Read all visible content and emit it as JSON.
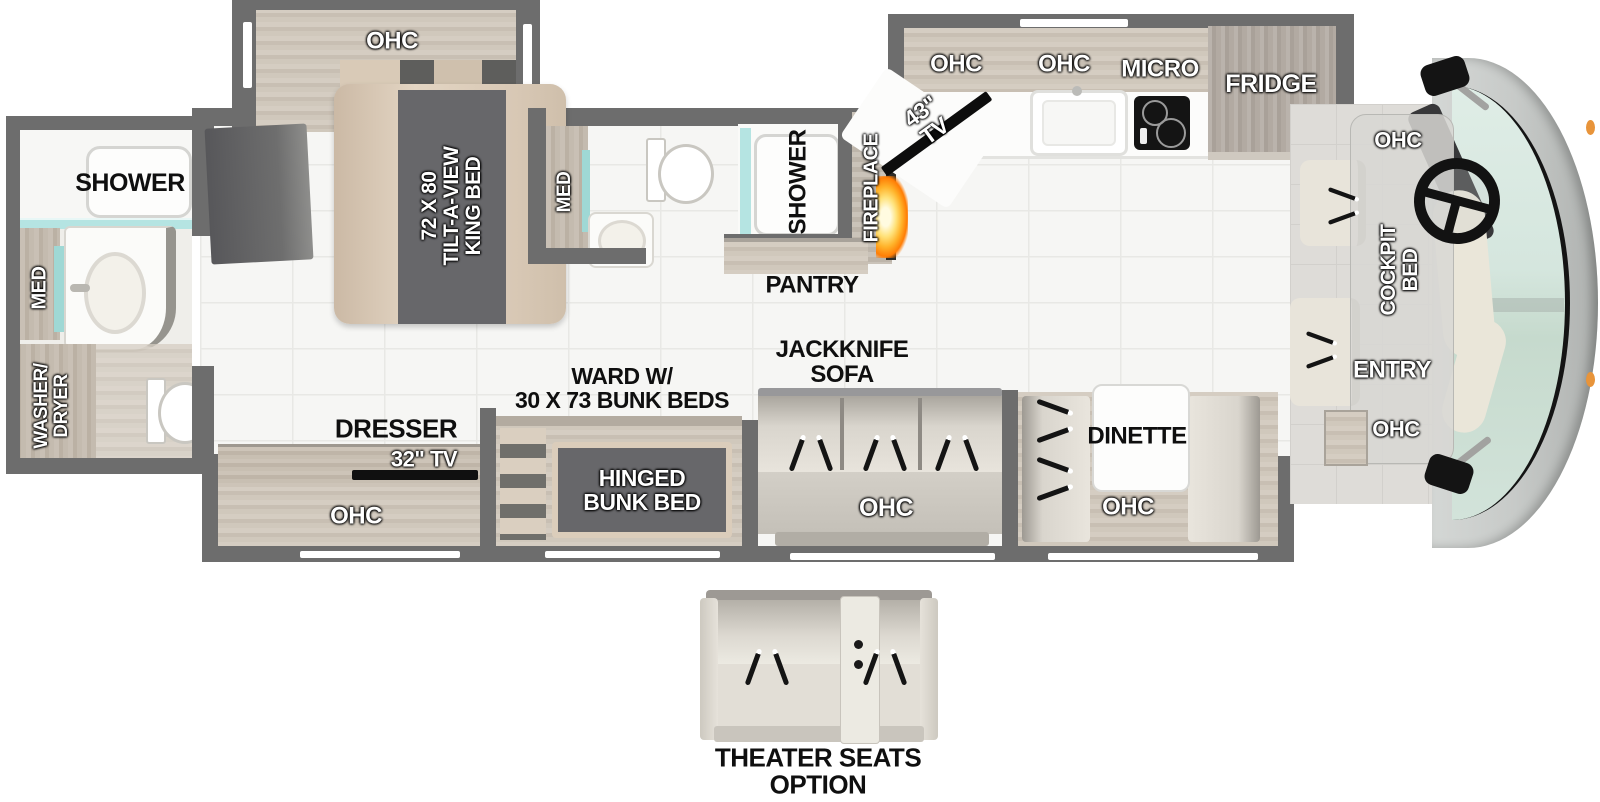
{
  "title": "RV floor plan",
  "colors": {
    "wall": "#6d6d6d",
    "teal_glass": "#b5e4e2",
    "flame_orange": "#ff8a00",
    "windshield_glass": "#d5e6de",
    "label_black": "#0f0f0f",
    "label_white": "#ffffff"
  },
  "rear_bath": {
    "shower": "SHOWER",
    "med": "MED",
    "washer_dryer": "WASHER/\nDRYER"
  },
  "bedroom": {
    "ohc": "OHC",
    "king_bed": "72 X 80\nTILT-A-VIEW\nKING BED"
  },
  "mid_bath": {
    "med": "MED",
    "shower": "SHOWER"
  },
  "living": {
    "fireplace": "FIREPLACE",
    "pantry": "PANTRY",
    "tv_43": "43\" TV",
    "dresser": "DRESSER",
    "tv_32": "32\" TV",
    "dresser_ohc": "OHC",
    "ward_bunks": "WARD W/\n30 X 73 BUNK BEDS",
    "hinged_bunk": "HINGED\nBUNK BED",
    "jackknife_sofa": "JACKKNIFE\nSOFA",
    "sofa_ohc": "OHC",
    "dinette": "DINETTE",
    "dinette_ohc": "OHC"
  },
  "kitchen": {
    "ohc_left": "OHC",
    "ohc_right": "OHC",
    "micro": "MICRO",
    "fridge": "FRIDGE"
  },
  "cockpit": {
    "ohc_top": "OHC",
    "cockpit_bed": "COCKPIT\nBED",
    "entry": "ENTRY",
    "ohc_bottom": "OHC"
  },
  "options": {
    "theater_seats": "THEATER SEATS\nOPTION"
  }
}
